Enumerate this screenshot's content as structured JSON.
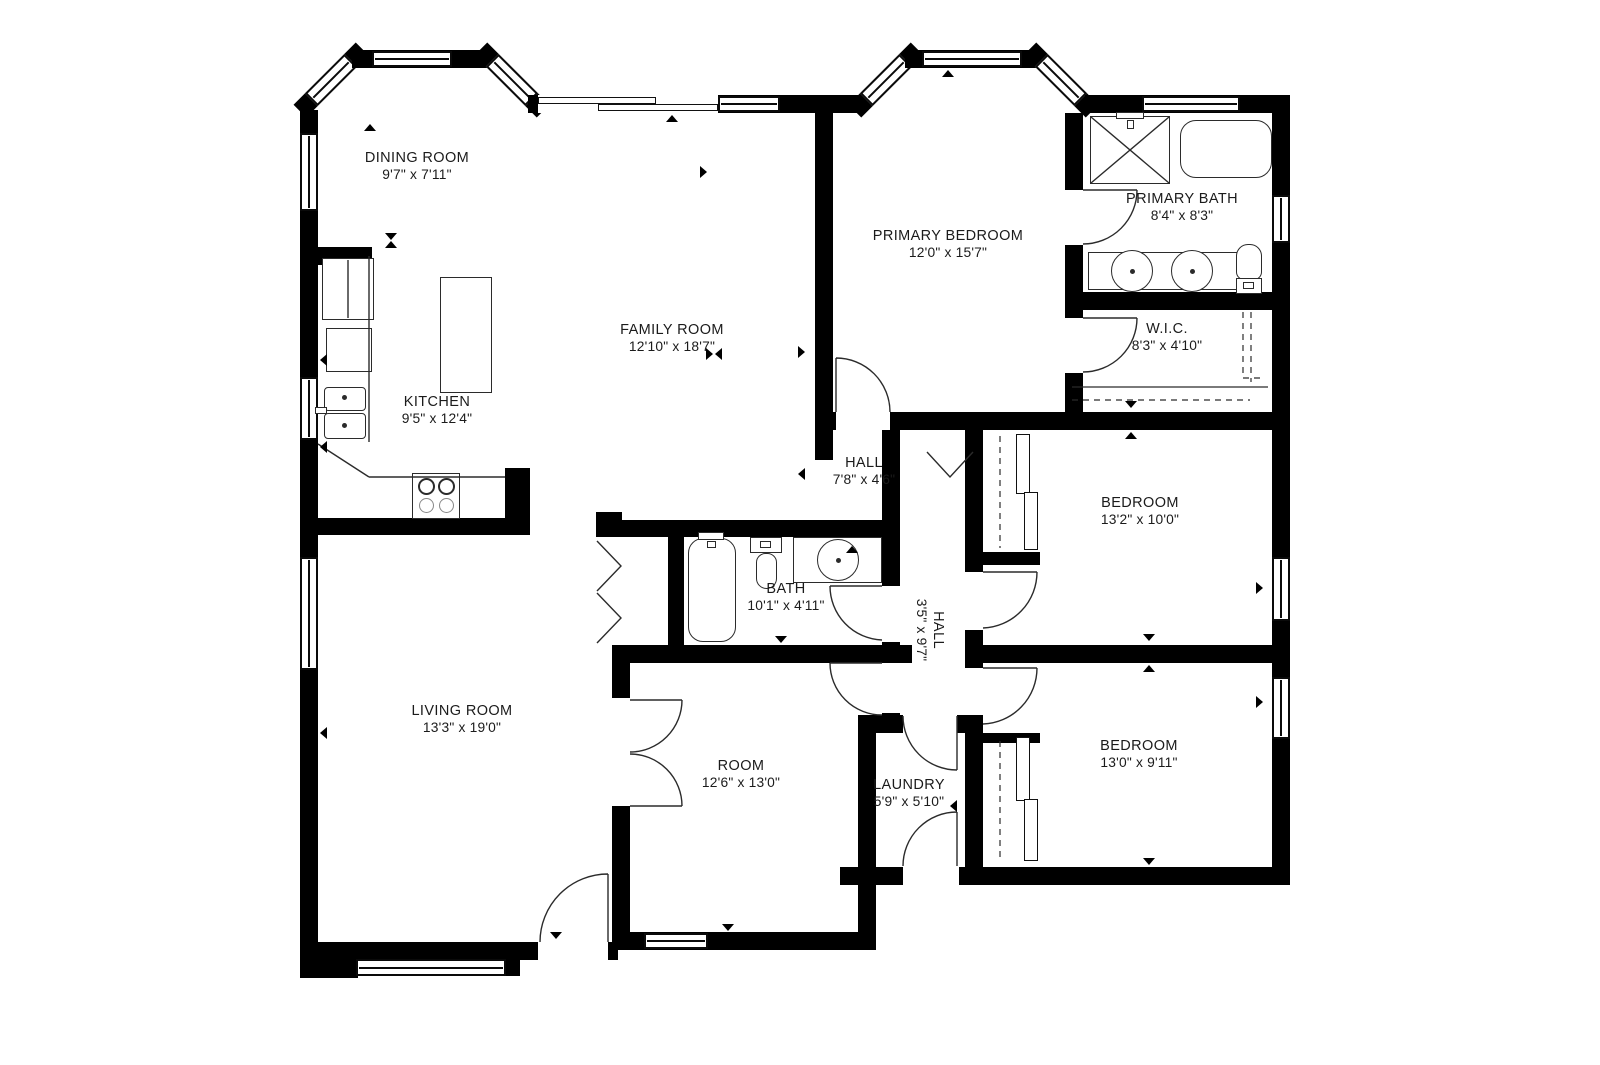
{
  "colors": {
    "background": "#ffffff",
    "walls": "#000000",
    "text": "#1b1b1b",
    "fixture_lines": "#2b2b2b"
  },
  "floorplan": {
    "rooms": [
      {
        "id": "dining-room",
        "name": "DINING ROOM",
        "dims": "9'7\" x 7'11\""
      },
      {
        "id": "family-room",
        "name": "FAMILY ROOM",
        "dims": "12'10\" x 18'7\""
      },
      {
        "id": "kitchen",
        "name": "KITCHEN",
        "dims": "9'5\" x 12'4\""
      },
      {
        "id": "primary-bedroom",
        "name": "PRIMARY BEDROOM",
        "dims": "12'0\" x 15'7\""
      },
      {
        "id": "primary-bath",
        "name": "PRIMARY BATH",
        "dims": "8'4\" x 8'3\""
      },
      {
        "id": "walk-in-closet",
        "name": "W.I.C.",
        "dims": "8'3\" x 4'10\""
      },
      {
        "id": "hall-upper",
        "name": "HALL",
        "dims": "7'8\" x 4'6\""
      },
      {
        "id": "bedroom-ne",
        "name": "BEDROOM",
        "dims": "13'2\" x 10'0\""
      },
      {
        "id": "bath",
        "name": "BATH",
        "dims": "10'1\" x 4'11\""
      },
      {
        "id": "hall-vertical",
        "name": "HALL",
        "dims": "3'5\" x 9'7\"",
        "rotated": true
      },
      {
        "id": "living-room",
        "name": "LIVING ROOM",
        "dims": "13'3\" x 19'0\""
      },
      {
        "id": "room",
        "name": "ROOM",
        "dims": "12'6\" x 13'0\""
      },
      {
        "id": "laundry",
        "name": "LAUNDRY",
        "dims": "5'9\" x 5'10\""
      },
      {
        "id": "bedroom-se",
        "name": "BEDROOM",
        "dims": "13'0\" x 9'11\""
      }
    ]
  }
}
